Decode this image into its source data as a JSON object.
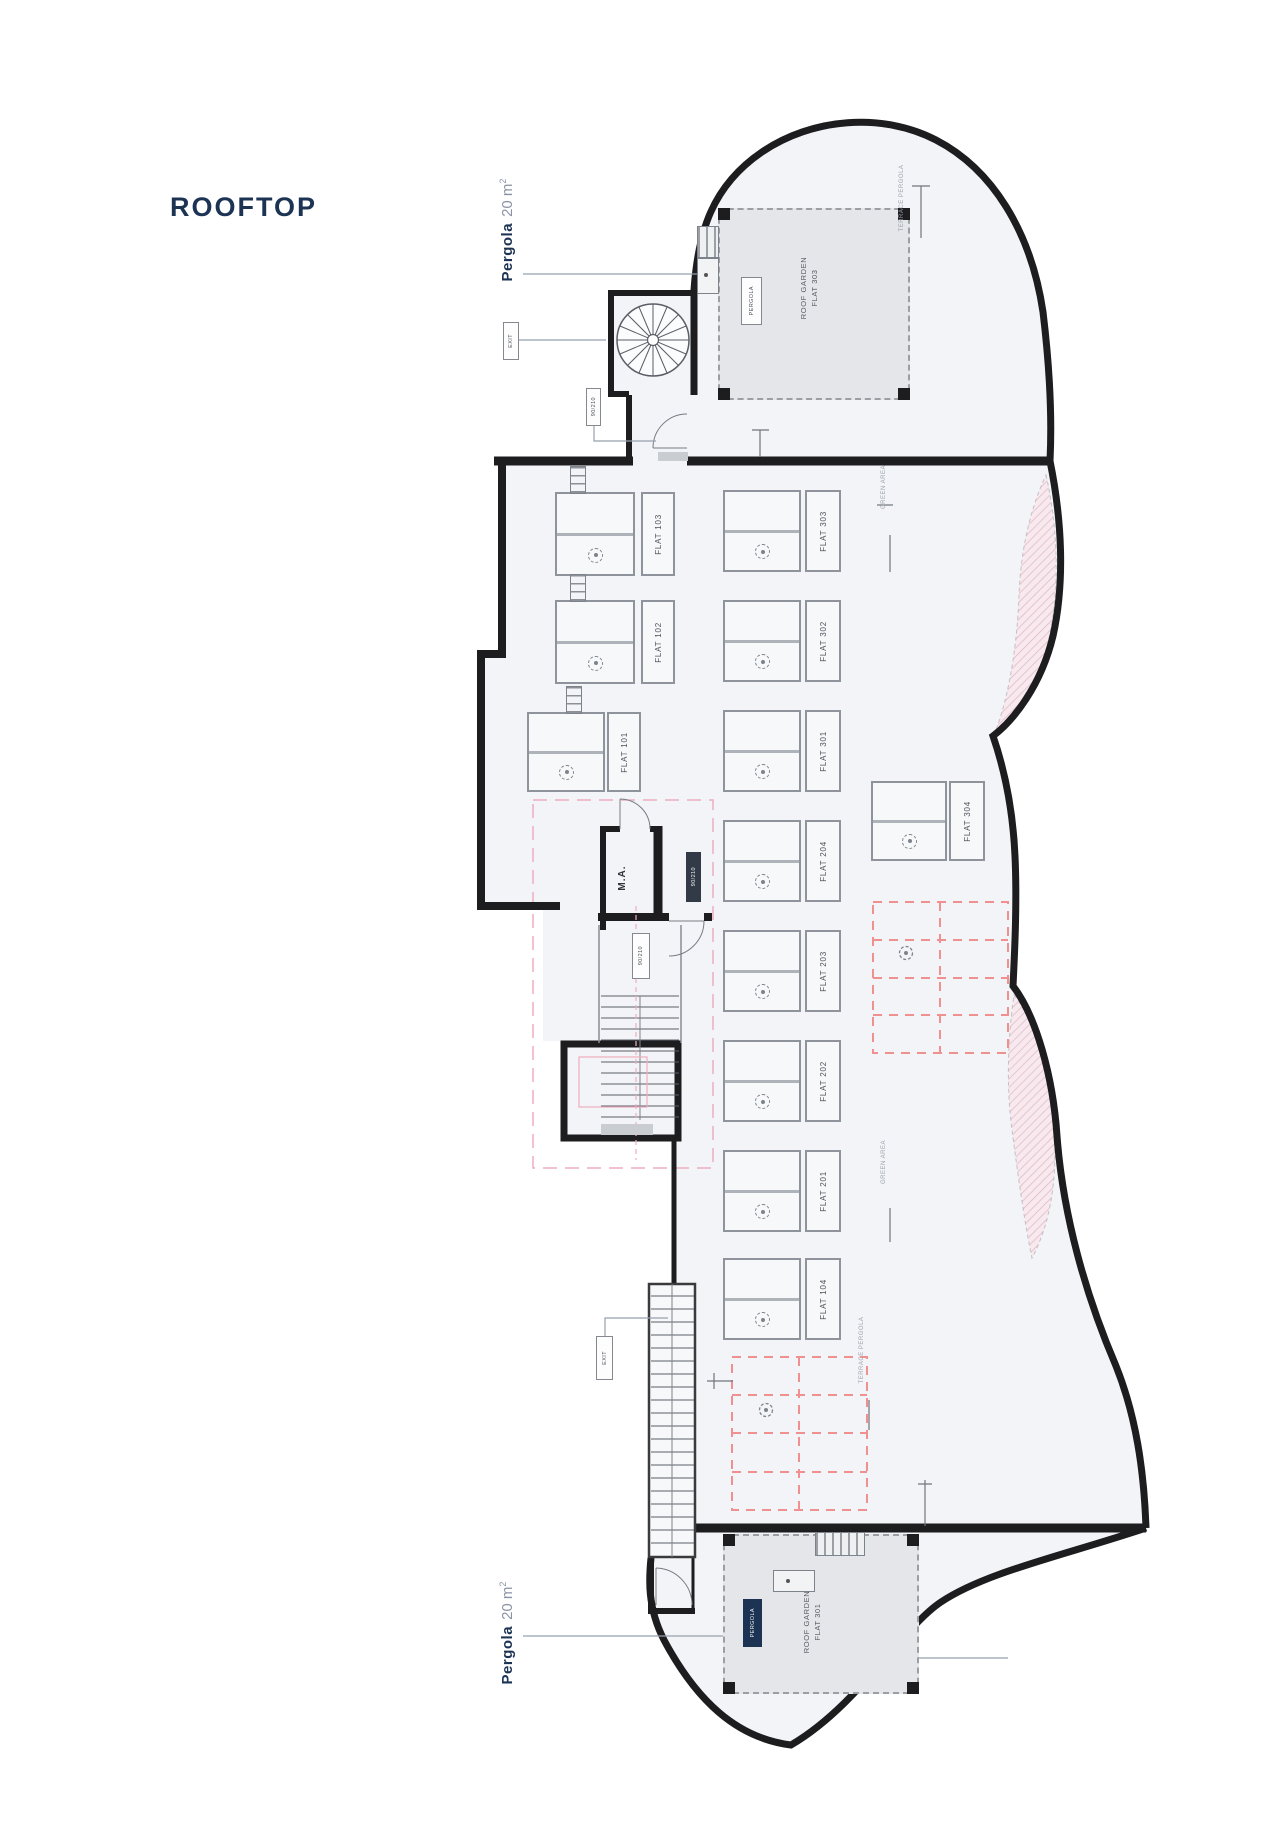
{
  "title": "ROOFTOP",
  "colors": {
    "navy": "#1c3354",
    "wall": "#1d1d20",
    "pink_dash": "#eeadbf",
    "salmon_dash": "#f09090",
    "garden_fill": "#e4e6e9",
    "interior_fill": "#f3f4f7",
    "leader_line": "#98a0ad"
  },
  "pergola_callouts": {
    "top": {
      "label": "Pergola",
      "area": "20 m",
      "sup": "2"
    },
    "bottom": {
      "label": "Pergola",
      "area": "20 m",
      "sup": "2"
    }
  },
  "gardens": {
    "top": {
      "line1": "ROOF GARDEN",
      "line2": "FLAT 303",
      "tag": "PERGOLA"
    },
    "bottom": {
      "line1": "ROOF GARDEN",
      "line2": "FLAT 301",
      "tag": "PERGOLA"
    }
  },
  "rooms": {
    "machine": "M.A."
  },
  "tags": {
    "door_top": "90/210",
    "exit_spiral": "EXIT",
    "ma_door": "90/210",
    "core_door": "90/210",
    "exit_stair": "EXIT"
  },
  "units": {
    "left": [
      {
        "label": "FLAT 103"
      },
      {
        "label": "FLAT 102"
      },
      {
        "label": "FLAT 101"
      }
    ],
    "right": [
      {
        "label": "FLAT 303"
      },
      {
        "label": "FLAT 302"
      },
      {
        "label": "FLAT 301"
      },
      {
        "label": "FLAT 204"
      },
      {
        "label": "FLAT 203"
      },
      {
        "label": "FLAT 202"
      },
      {
        "label": "FLAT 201"
      },
      {
        "label": "FLAT 104"
      }
    ],
    "wide": {
      "label": "FLAT 304"
    }
  },
  "edge_notes": {
    "ne_top": "TERRACE PERGOLA",
    "ne_mid": "GREEN AREA",
    "se_mid": "GREEN AREA",
    "se_bottom": "TERRACE PERGOLA"
  }
}
